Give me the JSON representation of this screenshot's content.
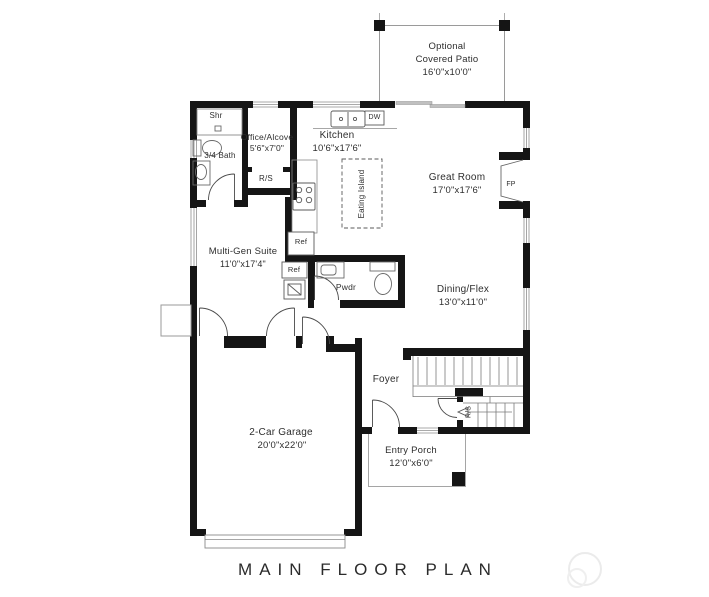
{
  "title": "MAIN FLOOR PLAN",
  "rooms": {
    "patio": {
      "line1": "Optional",
      "line2": "Covered Patio",
      "dims": "16'0\"x10'0\""
    },
    "kitchen": {
      "name": "Kitchen",
      "dims": "10'6\"x17'6\""
    },
    "office_alcove": {
      "name": "Office/Alcove",
      "dims": "5'6\"x7'0\""
    },
    "shower": {
      "name": "Shr"
    },
    "bath": {
      "name": "3/4 Bath"
    },
    "great_room": {
      "name": "Great Room",
      "dims": "17'0\"x17'6\""
    },
    "multi_gen_suite": {
      "name": "Multi-Gen Suite",
      "dims": "11'0\"x17'4\""
    },
    "dining_flex": {
      "name": "Dining/Flex",
      "dims": "13'0\"x11'0\""
    },
    "powder": {
      "name": "Pwdr"
    },
    "foyer": {
      "name": "Foyer"
    },
    "garage": {
      "name": "2-Car Garage",
      "dims": "20'0\"x22'0\""
    },
    "entry_porch": {
      "name": "Entry Porch",
      "dims": "12'0\"x6'0\""
    }
  },
  "fixtures": {
    "dishwasher": "DW",
    "kitchen_fridge": "Ref",
    "suite_fridge": "Ref",
    "fireplace": "FP",
    "eating_island": "Eating Island",
    "hall_closet": "R/S",
    "stair_closet": "R/S"
  },
  "colors": {
    "wall": "#151515",
    "thin_line": "#777777",
    "window_line": "#8f8f8f",
    "text": "#2e2e2e"
  }
}
